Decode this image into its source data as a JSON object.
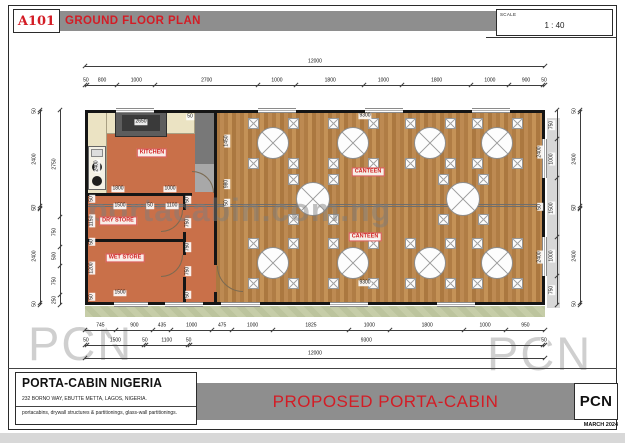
{
  "header": {
    "sheet_no": "A101",
    "title": "GROUND FLOOR PLAN",
    "scale_label": "SCALE",
    "scale_value": "1 : 40"
  },
  "titleblock": {
    "company": "PORTA-CABIN NIGERIA",
    "address": "232 BORNO WAY, EBUTTE METTA, LAGOS, NIGERIA.",
    "services": "portacabins, drywall structures & partitionings, glass-wall partitionings.",
    "project": "PROPOSED PORTA-CABIN",
    "logo": "PCN",
    "date": "MARCH 2024"
  },
  "watermarks": {
    "center": "portacabin.com.ng",
    "corner": "PCN"
  },
  "colors": {
    "accent_red": "#d31c25",
    "bar_gray": "#8e8e8e",
    "floor_orange": "#c97049",
    "floor_wood": "#b5834c",
    "counter_cream": "#ebe3c3"
  },
  "plan": {
    "overall_mm": {
      "width": "12000",
      "height": "5000"
    },
    "rooms": [
      {
        "name": "KITCHEN",
        "x": 152,
        "y": 153
      },
      {
        "name": "DRY STORE",
        "x": 118,
        "y": 221
      },
      {
        "name": "WET STORE",
        "x": 125,
        "y": 258
      },
      {
        "name": "CANTEEN",
        "x": 368,
        "y": 172
      },
      {
        "name": "CANTEEN",
        "x": 365,
        "y": 237
      }
    ],
    "chains": [
      {
        "o": "h",
        "x": 85,
        "y": 66,
        "len": 460,
        "vals": [
          "12000"
        ]
      },
      {
        "o": "h",
        "x": 85,
        "y": 85,
        "len": 460,
        "vals": [
          "50",
          "800",
          "1000",
          "2700",
          "1000",
          "1800",
          "1000",
          "1800",
          "1000",
          "900",
          "50"
        ]
      },
      {
        "o": "h",
        "x": 85,
        "y": 330,
        "len": 460,
        "vals": [
          "745",
          "900",
          "435",
          "1000",
          "475",
          "1000",
          "1825",
          "1000",
          "1800",
          "1000",
          "950"
        ]
      },
      {
        "o": "h",
        "x": 85,
        "y": 345,
        "len": 460,
        "vals": [
          "50",
          "1500",
          "50",
          "1100",
          "50",
          "9300",
          "50"
        ]
      },
      {
        "o": "h",
        "x": 85,
        "y": 358,
        "len": 460,
        "vals": [
          "12000"
        ]
      },
      {
        "o": "v",
        "x": 40,
        "y": 110,
        "len": 195,
        "vals": [
          "50",
          "2400",
          "50",
          "50",
          "2400",
          "50"
        ]
      },
      {
        "o": "v",
        "x": 60,
        "y": 110,
        "len": 195,
        "vals": [
          "2750",
          "750",
          "500",
          "750",
          "250"
        ]
      },
      {
        "o": "v",
        "x": 557,
        "y": 110,
        "len": 195,
        "vals": [
          "750",
          "1000",
          "1500",
          "1000",
          "750"
        ]
      },
      {
        "o": "v",
        "x": 580,
        "y": 110,
        "len": 195,
        "vals": [
          "50",
          "2400",
          "50",
          "50",
          "2400",
          "50"
        ]
      }
    ],
    "interior_dims": [
      {
        "t": "2650",
        "x": 141,
        "y": 122
      },
      {
        "t": "50",
        "x": 190,
        "y": 117
      },
      {
        "t": "2400",
        "x": 97,
        "y": 166,
        "r": 1
      },
      {
        "t": "1800",
        "x": 118,
        "y": 189
      },
      {
        "t": "1000",
        "x": 170,
        "y": 189
      },
      {
        "t": "1500",
        "x": 120,
        "y": 206
      },
      {
        "t": "50",
        "x": 150,
        "y": 206
      },
      {
        "t": "1100",
        "x": 172,
        "y": 206
      },
      {
        "t": "50",
        "x": 92,
        "y": 199,
        "r": 1
      },
      {
        "t": "1150",
        "x": 92,
        "y": 221,
        "r": 1
      },
      {
        "t": "50",
        "x": 92,
        "y": 242,
        "r": 1
      },
      {
        "t": "1200",
        "x": 92,
        "y": 268,
        "r": 1
      },
      {
        "t": "50",
        "x": 92,
        "y": 297,
        "r": 1
      },
      {
        "t": "50",
        "x": 188,
        "y": 200,
        "r": 1
      },
      {
        "t": "750",
        "x": 188,
        "y": 223,
        "r": 1
      },
      {
        "t": "750",
        "x": 188,
        "y": 247,
        "r": 1
      },
      {
        "t": "750",
        "x": 188,
        "y": 271,
        "r": 1
      },
      {
        "t": "50",
        "x": 188,
        "y": 295,
        "r": 1
      },
      {
        "t": "1500",
        "x": 120,
        "y": 293
      },
      {
        "t": "9300",
        "x": 365,
        "y": 116
      },
      {
        "t": "9300",
        "x": 365,
        "y": 283
      },
      {
        "t": "1450",
        "x": 227,
        "y": 141,
        "r": 1
      },
      {
        "t": "980",
        "x": 227,
        "y": 184,
        "r": 1
      },
      {
        "t": "50",
        "x": 227,
        "y": 203,
        "r": 1
      },
      {
        "t": "2400",
        "x": 540,
        "y": 152,
        "r": 1
      },
      {
        "t": "50",
        "x": 540,
        "y": 207,
        "r": 1
      },
      {
        "t": "2400",
        "x": 540,
        "y": 257,
        "r": 1
      }
    ],
    "tables": [
      {
        "x": 273,
        "y": 143,
        "r": 16
      },
      {
        "x": 353,
        "y": 143,
        "r": 16
      },
      {
        "x": 430,
        "y": 143,
        "r": 16
      },
      {
        "x": 497,
        "y": 143,
        "r": 16
      },
      {
        "x": 313,
        "y": 199,
        "r": 17
      },
      {
        "x": 463,
        "y": 199,
        "r": 17
      },
      {
        "x": 273,
        "y": 263,
        "r": 16
      },
      {
        "x": 353,
        "y": 263,
        "r": 16
      },
      {
        "x": 430,
        "y": 263,
        "r": 16
      },
      {
        "x": 497,
        "y": 263,
        "r": 16
      }
    ],
    "windows_mm": {
      "top": [
        [
          800,
          1800
        ],
        [
          4500,
          5500
        ],
        [
          7300,
          8300
        ],
        [
          10100,
          11100
        ]
      ],
      "bottom": [
        [
          745,
          1645
        ],
        [
          2080,
          3080
        ],
        [
          3555,
          4555
        ],
        [
          6380,
          7380
        ],
        [
          9180,
          10180
        ]
      ],
      "right": [
        [
          750,
          1750
        ],
        [
          3250,
          4250
        ]
      ]
    },
    "doors": [
      {
        "x": 161,
        "y": 210,
        "s": 22,
        "c": "br"
      },
      {
        "x": 161,
        "y": 255,
        "s": 22,
        "c": "br"
      },
      {
        "x": 192,
        "y": 171,
        "s": 22,
        "c": "tr"
      },
      {
        "x": 217,
        "y": 266,
        "s": 26,
        "c": "bl"
      }
    ]
  }
}
